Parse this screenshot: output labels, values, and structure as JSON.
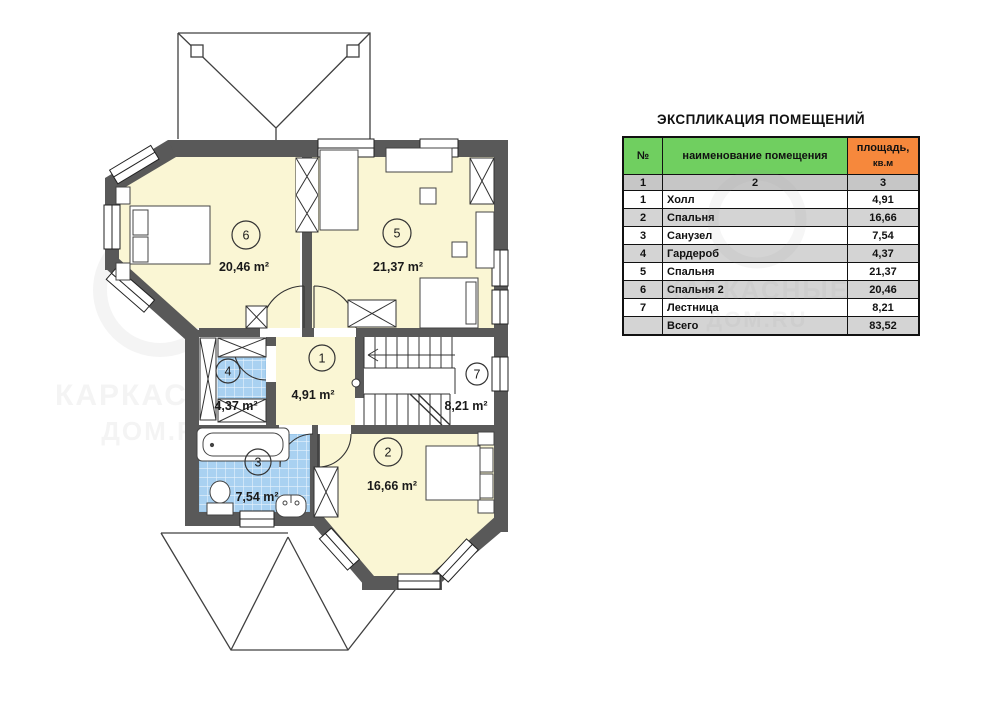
{
  "plan": {
    "rooms": [
      {
        "num": "1",
        "area_label": "4,91 m²"
      },
      {
        "num": "2",
        "area_label": "16,66 m²"
      },
      {
        "num": "3",
        "area_label": "7,54 m²"
      },
      {
        "num": "4",
        "area_label": "4,37 m²"
      },
      {
        "num": "5",
        "area_label": "21,37 m²"
      },
      {
        "num": "6",
        "area_label": "20,46 m²"
      },
      {
        "num": "7",
        "area_label": "8,21 m²"
      }
    ],
    "watermark": {
      "line1": "КАРКАСНЫЕ",
      "line2": "ДОМ.RU"
    },
    "colors": {
      "wall": "#595959",
      "room_yellow": "#faf6d4",
      "tile_blue": "#a9d1f1",
      "floor_white": "#ffffff",
      "outline": "#2c2c2c"
    }
  },
  "table": {
    "title": "ЭКСПЛИКАЦИЯ ПОМЕЩЕНИЙ",
    "col_headers": {
      "num": "№",
      "name": "наименование помещения",
      "area_line1": "площадь,",
      "area_line2": "кв.м"
    },
    "index_row": [
      "1",
      "2",
      "3"
    ],
    "rows": [
      {
        "num": "1",
        "name": "Холл",
        "area": "4,91"
      },
      {
        "num": "2",
        "name": "Спальня",
        "area": "16,66"
      },
      {
        "num": "3",
        "name": "Санузел",
        "area": "7,54"
      },
      {
        "num": "4",
        "name": "Гардероб",
        "area": "4,37"
      },
      {
        "num": "5",
        "name": "Спальня",
        "area": "21,37"
      },
      {
        "num": "6",
        "name": "Спальня 2",
        "area": "20,46"
      },
      {
        "num": "7",
        "name": "Лестница",
        "area": "8,21"
      }
    ],
    "total": {
      "label": "Всего",
      "area": "83,52"
    },
    "colors": {
      "header_green": "#70cf60",
      "header_orange": "#f6883c",
      "row_alt_gray": "#d4d4d4",
      "index_gray": "#c6c6c6"
    }
  }
}
